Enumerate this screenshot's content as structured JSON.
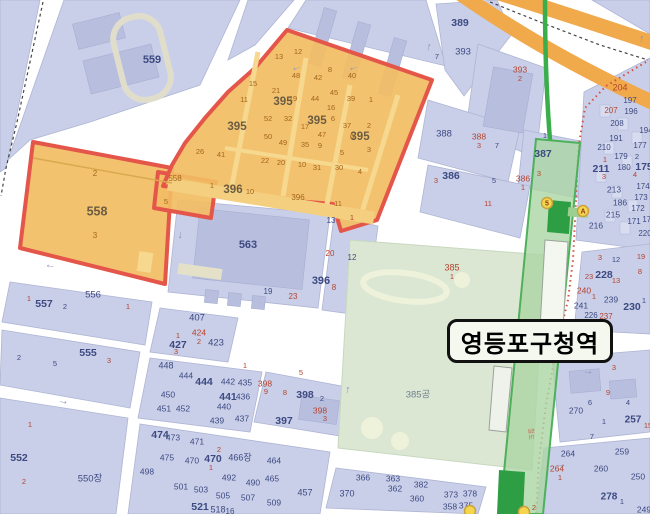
{
  "station": {
    "name": "영등포구청역"
  },
  "railway_label": "철도",
  "colors": {
    "n": "#3d4a82",
    "r": "#b5432e",
    "o": "#a3651c",
    "O": "#6b5c42",
    "g": "#71808f",
    "rw": "#c4705f",
    "arrow": "#8d95ba",
    "selection_fill": "#f2bd63",
    "selection_border": "#e4554a",
    "subway_green": "#3aae4b",
    "highway_orange": "#f0a94b"
  },
  "exits": [
    {
      "t": "5",
      "x": 547,
      "y": 203
    },
    {
      "t": "A",
      "x": 583,
      "y": 211
    },
    {
      "t": "",
      "x": 470,
      "y": 511
    },
    {
      "t": "",
      "x": 524,
      "y": 512
    }
  ],
  "arrows": [
    {
      "g": "←",
      "x": 297,
      "y": 70,
      "r": -18
    },
    {
      "g": "←",
      "x": 354,
      "y": 70,
      "r": -18
    },
    {
      "g": "↑",
      "x": 428,
      "y": 50,
      "r": 14
    },
    {
      "g": "↑",
      "x": 641,
      "y": 42,
      "r": 10
    },
    {
      "g": "↓",
      "x": 180,
      "y": 238,
      "r": 8
    },
    {
      "g": "←",
      "x": 50,
      "y": 268,
      "r": 8
    },
    {
      "g": "→",
      "x": 63,
      "y": 404,
      "r": 8
    },
    {
      "g": "→",
      "x": 588,
      "y": 374,
      "r": 4
    },
    {
      "g": "↑",
      "x": 347,
      "y": 393,
      "r": 12
    },
    {
      "g": "→",
      "x": 561,
      "y": 467,
      "r": 3
    }
  ],
  "labels": [
    [
      "559",
      152,
      60,
      "n",
      11
    ],
    [
      "13",
      279,
      57,
      "o",
      7.5
    ],
    [
      "12",
      298,
      52,
      "o",
      7.5
    ],
    [
      "48",
      296,
      76,
      "o",
      7.5
    ],
    [
      "42",
      318,
      78,
      "o",
      7.5
    ],
    [
      "8",
      330,
      70,
      "o",
      7.5
    ],
    [
      "15",
      253,
      84,
      "o",
      7.5
    ],
    [
      "21",
      276,
      91,
      "o",
      7.5
    ],
    [
      "19",
      293,
      99,
      "o",
      7.5
    ],
    [
      "44",
      315,
      99,
      "o",
      7.5
    ],
    [
      "45",
      334,
      93,
      "o",
      7.5
    ],
    [
      "16",
      331,
      108,
      "o",
      7.5
    ],
    [
      "40",
      352,
      76,
      "o",
      7.5
    ],
    [
      "39",
      351,
      99,
      "o",
      7.5
    ],
    [
      "1",
      371,
      100,
      "o",
      7.5
    ],
    [
      "11",
      244,
      100,
      "o",
      7.5
    ],
    [
      "52",
      268,
      119,
      "o",
      7.5
    ],
    [
      "32",
      288,
      119,
      "o",
      7.5
    ],
    [
      "6",
      333,
      119,
      "o",
      7.5
    ],
    [
      "17",
      305,
      127,
      "o",
      7.5
    ],
    [
      "37",
      347,
      126,
      "o",
      7.5
    ],
    [
      "2",
      369,
      126,
      "o",
      7.5
    ],
    [
      "47",
      322,
      135,
      "o",
      7.5
    ],
    [
      "50",
      268,
      137,
      "o",
      7.5
    ],
    [
      "49",
      283,
      143,
      "o",
      7.5
    ],
    [
      "35",
      305,
      145,
      "o",
      7.5
    ],
    [
      "9",
      320,
      146,
      "o",
      7.5
    ],
    [
      "6",
      352,
      137,
      "o",
      7.5
    ],
    [
      "5",
      342,
      153,
      "o",
      7.5
    ],
    [
      "3",
      369,
      150,
      "o",
      7.5
    ],
    [
      "26",
      200,
      152,
      "o",
      7.5
    ],
    [
      "41",
      221,
      155,
      "o",
      7.5
    ],
    [
      "22",
      265,
      161,
      "o",
      7.5
    ],
    [
      "20",
      281,
      163,
      "o",
      7.5
    ],
    [
      "10",
      302,
      165,
      "o",
      7.5
    ],
    [
      "31",
      317,
      168,
      "o",
      7.5
    ],
    [
      "30",
      339,
      168,
      "o",
      7.5
    ],
    [
      "4",
      360,
      172,
      "o",
      7.5
    ],
    [
      "1",
      212,
      186,
      "o",
      7.5
    ],
    [
      "10",
      250,
      192,
      "o",
      7.5
    ],
    [
      "11",
      338,
      204,
      "o",
      7.5
    ],
    [
      "5",
      166,
      202,
      "o",
      7.5
    ],
    [
      "2",
      95,
      174,
      "o",
      8
    ],
    [
      "3",
      95,
      236,
      "o",
      8
    ],
    [
      "558",
      175,
      179,
      "o",
      8
    ],
    [
      "396",
      298,
      198,
      "o",
      8
    ],
    [
      "395",
      237,
      127,
      "O",
      11.5
    ],
    [
      "395",
      283,
      102,
      "O",
      11.5
    ],
    [
      "395",
      317,
      121,
      "O",
      11.5
    ],
    [
      "395",
      360,
      137,
      "O",
      11.5
    ],
    [
      "396",
      233,
      190,
      "O",
      11.5
    ],
    [
      "558",
      97,
      212,
      "O",
      12.5
    ],
    [
      "13",
      331,
      221,
      "n",
      8
    ],
    [
      "1",
      352,
      218,
      "r",
      7.5
    ],
    [
      "563",
      248,
      245,
      "n",
      11
    ],
    [
      "20",
      330,
      254,
      "r",
      8
    ],
    [
      "12",
      352,
      258,
      "n",
      8
    ],
    [
      "396",
      321,
      281,
      "n",
      11
    ],
    [
      "8",
      334,
      288,
      "r",
      8
    ],
    [
      "19",
      268,
      292,
      "n",
      8
    ],
    [
      "23",
      293,
      297,
      "r",
      8
    ],
    [
      "386",
      451,
      176,
      "n",
      10.5
    ],
    [
      "3",
      436,
      181,
      "r",
      7.5
    ],
    [
      "5",
      494,
      181,
      "n",
      7.5
    ],
    [
      "386",
      523,
      179,
      "r",
      8.5
    ],
    [
      "1",
      523,
      188,
      "r",
      7.5
    ],
    [
      "11",
      488,
      204,
      "r",
      7.5
    ],
    [
      "387",
      543,
      154,
      "n",
      10.5
    ],
    [
      "3",
      539,
      174,
      "r",
      7.5
    ],
    [
      "388",
      444,
      134,
      "n",
      9.5
    ],
    [
      "388",
      479,
      137,
      "r",
      8.5
    ],
    [
      "3",
      479,
      146,
      "r",
      7.5
    ],
    [
      "7",
      497,
      146,
      "n",
      7.5
    ],
    [
      "1",
      545,
      136,
      "n",
      7.5
    ],
    [
      "389",
      460,
      23,
      "n",
      10.5
    ],
    [
      "393",
      463,
      52,
      "n",
      9.5
    ],
    [
      "393",
      520,
      70,
      "r",
      8.5
    ],
    [
      "2",
      520,
      79,
      "r",
      7.5
    ],
    [
      "7",
      437,
      57,
      "n",
      7.5
    ],
    [
      "204",
      620,
      88,
      "r",
      9
    ],
    [
      "197",
      630,
      101,
      "n",
      8
    ],
    [
      "207",
      611,
      111,
      "r",
      8
    ],
    [
      "196",
      631,
      112,
      "n",
      8
    ],
    [
      "208",
      617,
      124,
      "n",
      8
    ],
    [
      "194",
      646,
      131,
      "n",
      8
    ],
    [
      "191",
      616,
      139,
      "n",
      8
    ],
    [
      "210",
      604,
      148,
      "n",
      8
    ],
    [
      "177",
      640,
      146,
      "n",
      8
    ],
    [
      "179",
      621,
      157,
      "n",
      8
    ],
    [
      "2",
      637,
      157,
      "n",
      7.5
    ],
    [
      "1",
      605,
      160,
      "r",
      7.5
    ],
    [
      "211",
      601,
      169,
      "n",
      10.5
    ],
    [
      "180",
      624,
      168,
      "n",
      8
    ],
    [
      "175",
      644,
      167,
      "n",
      10.5
    ],
    [
      "4",
      635,
      175,
      "r",
      7.5
    ],
    [
      "3",
      604,
      177,
      "r",
      7.5
    ],
    [
      "213",
      614,
      190,
      "n",
      8.5
    ],
    [
      "174",
      643,
      187,
      "n",
      8
    ],
    [
      "186",
      620,
      203,
      "n",
      8.5
    ],
    [
      "173",
      641,
      198,
      "n",
      8
    ],
    [
      "215",
      613,
      215,
      "n",
      8.5
    ],
    [
      "172",
      638,
      209,
      "n",
      8
    ],
    [
      "216",
      596,
      226,
      "n",
      8.5
    ],
    [
      "171",
      634,
      222,
      "n",
      8
    ],
    [
      "170",
      649,
      220,
      "n",
      8
    ],
    [
      "220",
      645,
      234,
      "n",
      8
    ],
    [
      "3",
      600,
      258,
      "r",
      7.5
    ],
    [
      "12",
      616,
      260,
      "n",
      7.5
    ],
    [
      "19",
      641,
      257,
      "r",
      7.5
    ],
    [
      "23",
      589,
      277,
      "r",
      7.5
    ],
    [
      "228",
      604,
      275,
      "n",
      10.5
    ],
    [
      "13",
      616,
      281,
      "r",
      7.5
    ],
    [
      "8",
      640,
      272,
      "r",
      7.5
    ],
    [
      "240",
      584,
      291,
      "r",
      8.5
    ],
    [
      "1",
      594,
      297,
      "r",
      7.5
    ],
    [
      "239",
      611,
      300,
      "n",
      8.5
    ],
    [
      "241",
      581,
      306,
      "n",
      8.5
    ],
    [
      "230",
      632,
      307,
      "n",
      10.5
    ],
    [
      "1",
      644,
      301,
      "n",
      7.5
    ],
    [
      "226",
      591,
      316,
      "n",
      8
    ],
    [
      "237",
      606,
      317,
      "r",
      8
    ],
    [
      "385",
      452,
      268,
      "r",
      9
    ],
    [
      "1",
      452,
      277,
      "r",
      7.5
    ],
    [
      "385공",
      418,
      395,
      "g",
      9.5
    ],
    [
      "1",
      29,
      299,
      "r",
      7.5
    ],
    [
      "557",
      44,
      304,
      "n",
      10.5
    ],
    [
      "2",
      65,
      307,
      "n",
      7.5
    ],
    [
      "556",
      93,
      295,
      "n",
      9.5
    ],
    [
      "1",
      128,
      307,
      "r",
      7.5
    ],
    [
      "2",
      19,
      358,
      "n",
      7.5
    ],
    [
      "5",
      55,
      364,
      "n",
      7.5
    ],
    [
      "555",
      88,
      353,
      "n",
      10.5
    ],
    [
      "3",
      109,
      361,
      "r",
      7.5
    ],
    [
      "552",
      19,
      458,
      "n",
      10.5
    ],
    [
      "2",
      24,
      482,
      "r",
      7.5
    ],
    [
      "550장",
      90,
      479,
      "n",
      9.5
    ],
    [
      "1",
      30,
      425,
      "r",
      7.5
    ],
    [
      "407",
      197,
      318,
      "n",
      9.5
    ],
    [
      "424",
      199,
      333,
      "r",
      8.5
    ],
    [
      "1",
      178,
      336,
      "r",
      7.5
    ],
    [
      "427",
      178,
      345,
      "n",
      10.5
    ],
    [
      "2",
      199,
      342,
      "r",
      7.5
    ],
    [
      "423",
      216,
      343,
      "n",
      9.5
    ],
    [
      "3",
      176,
      352,
      "r",
      7.5
    ],
    [
      "448",
      166,
      366,
      "n",
      9
    ],
    [
      "444",
      186,
      376,
      "n",
      8.5
    ],
    [
      "444",
      204,
      382,
      "n",
      10.5
    ],
    [
      "442",
      228,
      382,
      "n",
      8.5
    ],
    [
      "450",
      168,
      395,
      "n",
      8.5
    ],
    [
      "441",
      228,
      397,
      "n",
      10.5
    ],
    [
      "451",
      164,
      409,
      "n",
      8.5
    ],
    [
      "452",
      183,
      409,
      "n",
      8.5
    ],
    [
      "440",
      224,
      407,
      "n",
      8.5
    ],
    [
      "439",
      217,
      421,
      "n",
      8.5
    ],
    [
      "435",
      245,
      383,
      "n",
      8.5
    ],
    [
      "398",
      265,
      384,
      "r",
      8.5
    ],
    [
      "9",
      266,
      392,
      "r",
      7.5
    ],
    [
      "1",
      245,
      366,
      "r",
      7.5
    ],
    [
      "5",
      301,
      373,
      "r",
      7.5
    ],
    [
      "436",
      243,
      397,
      "n",
      8.5
    ],
    [
      "8",
      285,
      393,
      "r",
      7.5
    ],
    [
      "398",
      305,
      395,
      "n",
      10.5
    ],
    [
      "2",
      322,
      399,
      "n",
      7.5
    ],
    [
      "398",
      320,
      411,
      "r",
      8.5
    ],
    [
      "3",
      325,
      419,
      "r",
      7.5
    ],
    [
      "437",
      242,
      419,
      "n",
      8.5
    ],
    [
      "397",
      284,
      421,
      "n",
      10.5
    ],
    [
      "474",
      160,
      435,
      "n",
      10.5
    ],
    [
      "473",
      173,
      438,
      "n",
      8.5
    ],
    [
      "471",
      197,
      442,
      "n",
      8.5
    ],
    [
      "2",
      219,
      450,
      "r",
      7.5
    ],
    [
      "475",
      167,
      458,
      "n",
      8.5
    ],
    [
      "470",
      192,
      461,
      "n",
      8.5
    ],
    [
      "470",
      213,
      459,
      "n",
      10.5
    ],
    [
      "1",
      211,
      468,
      "r",
      7.5
    ],
    [
      "466장",
      240,
      458,
      "n",
      9
    ],
    [
      "464",
      274,
      461,
      "n",
      8.5
    ],
    [
      "498",
      147,
      472,
      "n",
      8.5
    ],
    [
      "492",
      229,
      478,
      "n",
      8.5
    ],
    [
      "490",
      253,
      483,
      "n",
      8.5
    ],
    [
      "465",
      272,
      479,
      "n",
      8.5
    ],
    [
      "501",
      181,
      487,
      "n",
      8.5
    ],
    [
      "503",
      201,
      490,
      "n",
      8.5
    ],
    [
      "505",
      223,
      496,
      "n",
      8.5
    ],
    [
      "507",
      248,
      498,
      "n",
      8.5
    ],
    [
      "509",
      274,
      503,
      "n",
      8.5
    ],
    [
      "457",
      305,
      493,
      "n",
      9
    ],
    [
      "521",
      200,
      507,
      "n",
      10.5
    ],
    [
      "518",
      218,
      510,
      "n",
      9
    ],
    [
      "16",
      230,
      512,
      "n",
      8
    ],
    [
      "366",
      363,
      478,
      "n",
      8.5
    ],
    [
      "363",
      393,
      479,
      "n",
      8.5
    ],
    [
      "362",
      395,
      489,
      "n",
      8.5
    ],
    [
      "382",
      421,
      485,
      "n",
      8.5
    ],
    [
      "370",
      347,
      494,
      "n",
      9
    ],
    [
      "360",
      417,
      499,
      "n",
      8.5
    ],
    [
      "373",
      451,
      495,
      "n",
      8.5
    ],
    [
      "378",
      470,
      494,
      "n",
      8.5
    ],
    [
      "358",
      450,
      507,
      "n",
      8.5
    ],
    [
      "375",
      466,
      506,
      "n",
      8.5
    ],
    [
      "2",
      534,
      508,
      "r",
      7.5
    ],
    [
      "264",
      557,
      469,
      "r",
      8.5
    ],
    [
      "1",
      560,
      478,
      "r",
      7.5
    ],
    [
      "260",
      601,
      469,
      "n",
      8.5
    ],
    [
      "250",
      638,
      477,
      "n",
      8.5
    ],
    [
      "278",
      609,
      497,
      "n",
      10
    ],
    [
      "1",
      622,
      502,
      "n",
      7.5
    ],
    [
      "249",
      644,
      510,
      "n",
      8.5
    ],
    [
      "270",
      576,
      411,
      "n",
      8.5
    ],
    [
      "264",
      568,
      454,
      "n",
      8.5
    ],
    [
      "259",
      622,
      452,
      "n",
      8.5
    ],
    [
      "257",
      633,
      420,
      "n",
      10
    ],
    [
      "15",
      648,
      426,
      "r",
      7.5
    ],
    [
      "3",
      614,
      368,
      "r",
      7.5
    ],
    [
      "9",
      608,
      393,
      "r",
      7.5
    ],
    [
      "6",
      590,
      403,
      "n",
      7.5
    ],
    [
      "4",
      628,
      403,
      "n",
      7.5
    ],
    [
      "1",
      604,
      422,
      "n",
      7.5
    ],
    [
      "7",
      592,
      437,
      "n",
      7.5
    ]
  ]
}
